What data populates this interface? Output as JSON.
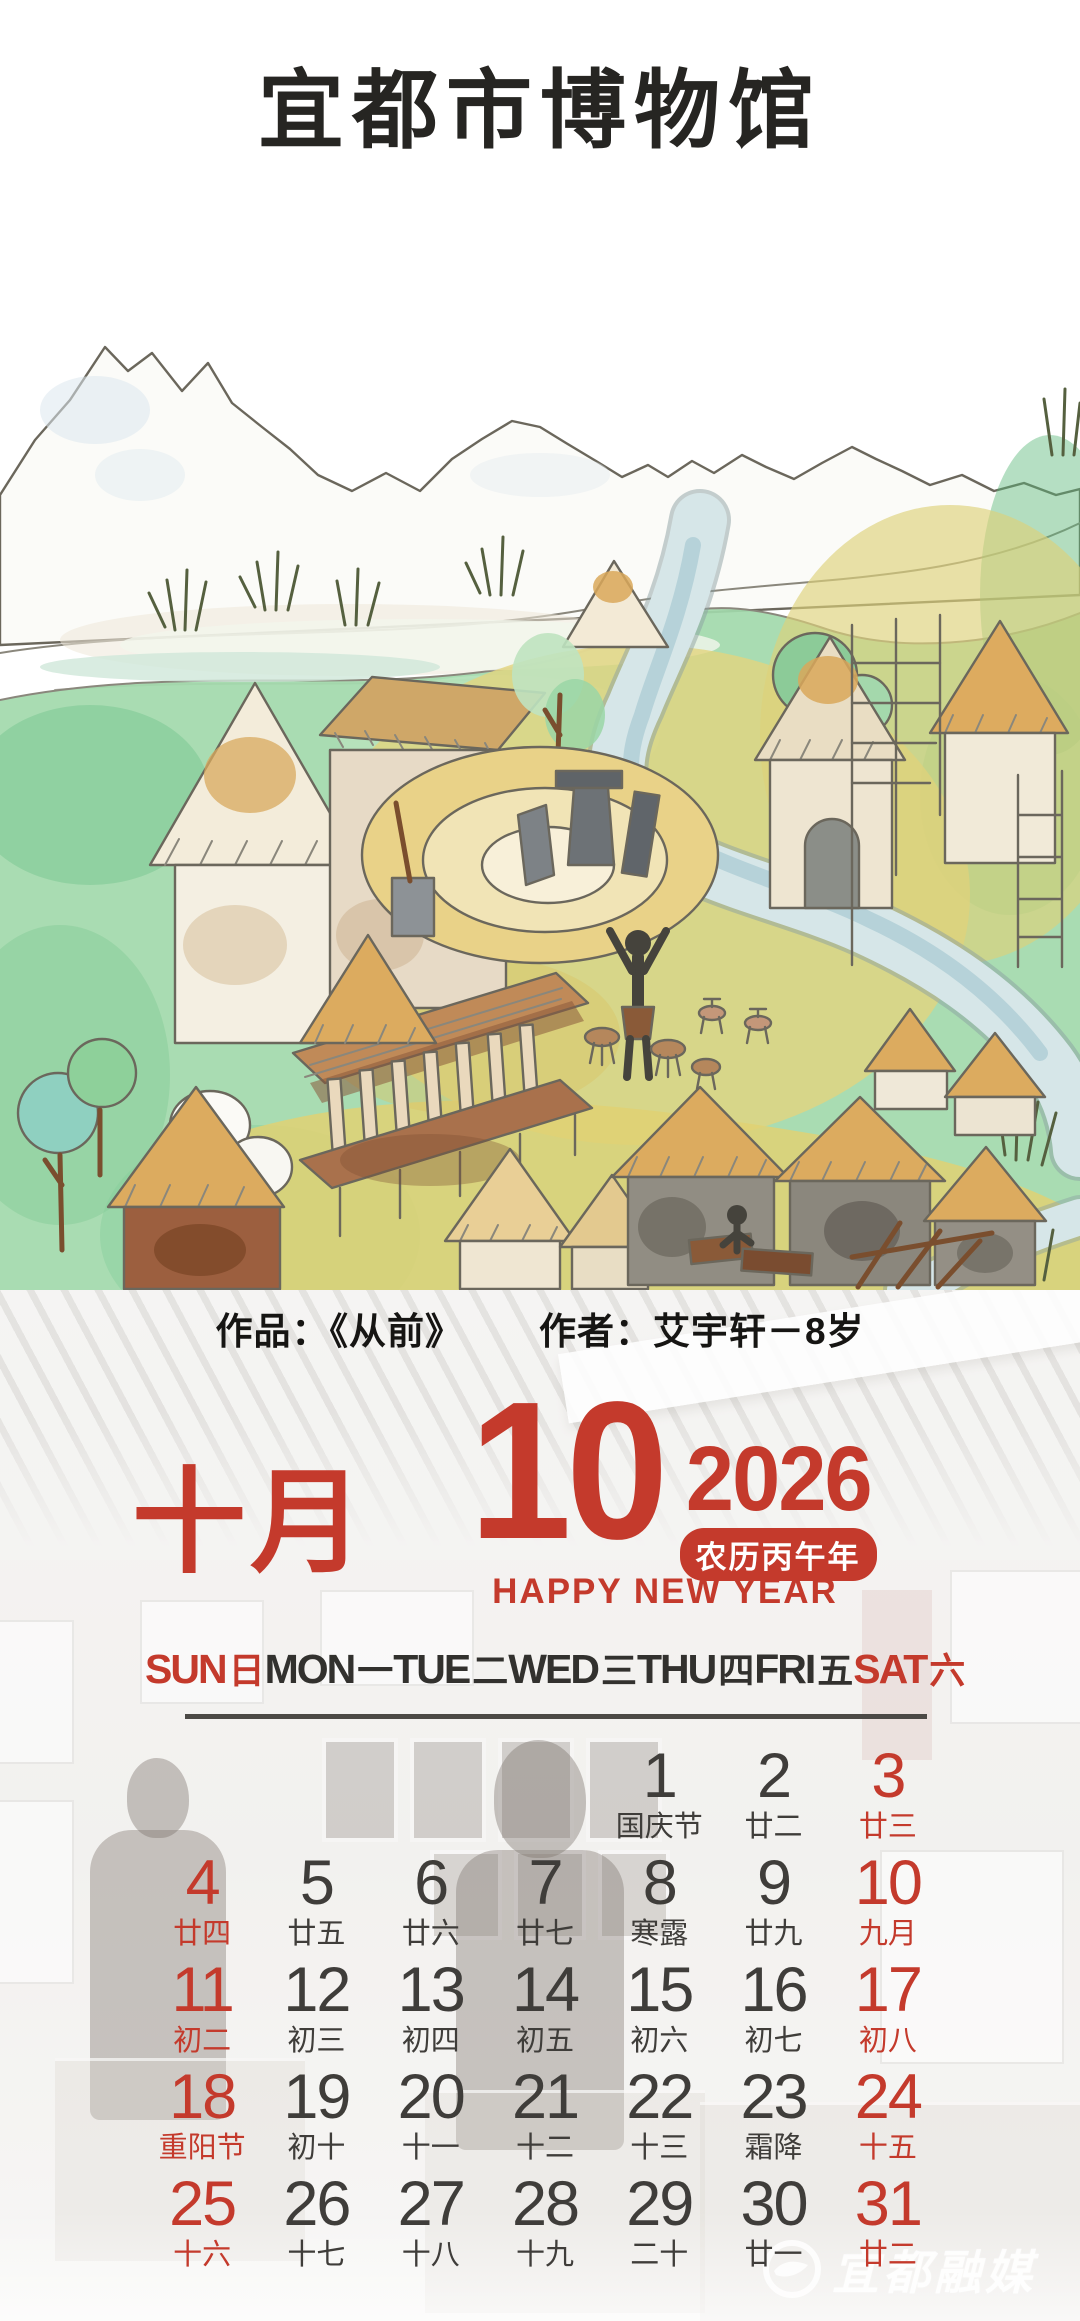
{
  "header": {
    "museum_title": "宜都市博物馆"
  },
  "artwork": {
    "caption_work": "作品：《从前》",
    "caption_author": "作者：艾宇轩－8岁"
  },
  "calendar": {
    "month_cn": "十月",
    "month_num": "10",
    "year": "2026",
    "lunar_year": "农历丙午年",
    "greeting": "HAPPY NEW YEAR",
    "weekdays": [
      {
        "en": "SUN",
        "cn": "日",
        "red": true
      },
      {
        "en": "MON",
        "cn": "一",
        "red": false
      },
      {
        "en": "TUE",
        "cn": "二",
        "red": false
      },
      {
        "en": "WED",
        "cn": "三",
        "red": false
      },
      {
        "en": "THU",
        "cn": "四",
        "red": false
      },
      {
        "en": "FRI",
        "cn": "五",
        "red": false
      },
      {
        "en": "SAT",
        "cn": "六",
        "red": true
      }
    ],
    "weeks": [
      [
        null,
        null,
        null,
        null,
        {
          "day": "1",
          "lunar": "国庆节",
          "red": false
        },
        {
          "day": "2",
          "lunar": "廿二",
          "red": false
        },
        {
          "day": "3",
          "lunar": "廿三",
          "red": true
        }
      ],
      [
        {
          "day": "4",
          "lunar": "廿四",
          "red": true
        },
        {
          "day": "5",
          "lunar": "廿五",
          "red": false
        },
        {
          "day": "6",
          "lunar": "廿六",
          "red": false
        },
        {
          "day": "7",
          "lunar": "廿七",
          "red": false
        },
        {
          "day": "8",
          "lunar": "寒露",
          "red": false
        },
        {
          "day": "9",
          "lunar": "廿九",
          "red": false
        },
        {
          "day": "10",
          "lunar": "九月",
          "red": true
        }
      ],
      [
        {
          "day": "11",
          "lunar": "初二",
          "red": true
        },
        {
          "day": "12",
          "lunar": "初三",
          "red": false
        },
        {
          "day": "13",
          "lunar": "初四",
          "red": false
        },
        {
          "day": "14",
          "lunar": "初五",
          "red": false
        },
        {
          "day": "15",
          "lunar": "初六",
          "red": false
        },
        {
          "day": "16",
          "lunar": "初七",
          "red": false
        },
        {
          "day": "17",
          "lunar": "初八",
          "red": true
        }
      ],
      [
        {
          "day": "18",
          "lunar": "重阳节",
          "red": true
        },
        {
          "day": "19",
          "lunar": "初十",
          "red": false
        },
        {
          "day": "20",
          "lunar": "十一",
          "red": false
        },
        {
          "day": "21",
          "lunar": "十二",
          "red": false
        },
        {
          "day": "22",
          "lunar": "十三",
          "red": false
        },
        {
          "day": "23",
          "lunar": "霜降",
          "red": false
        },
        {
          "day": "24",
          "lunar": "十五",
          "red": true
        }
      ],
      [
        {
          "day": "25",
          "lunar": "十六",
          "red": true
        },
        {
          "day": "26",
          "lunar": "十七",
          "red": false
        },
        {
          "day": "27",
          "lunar": "十八",
          "red": false
        },
        {
          "day": "28",
          "lunar": "十九",
          "red": false
        },
        {
          "day": "29",
          "lunar": "二十",
          "red": false
        },
        {
          "day": "30",
          "lunar": "廿一",
          "red": false
        },
        {
          "day": "31",
          "lunar": "廿二",
          "red": true
        }
      ]
    ]
  },
  "watermark": {
    "text": "宜都融媒"
  },
  "colors": {
    "accent_red": "#c43a2c",
    "date_dark": "#3f3d3a"
  }
}
